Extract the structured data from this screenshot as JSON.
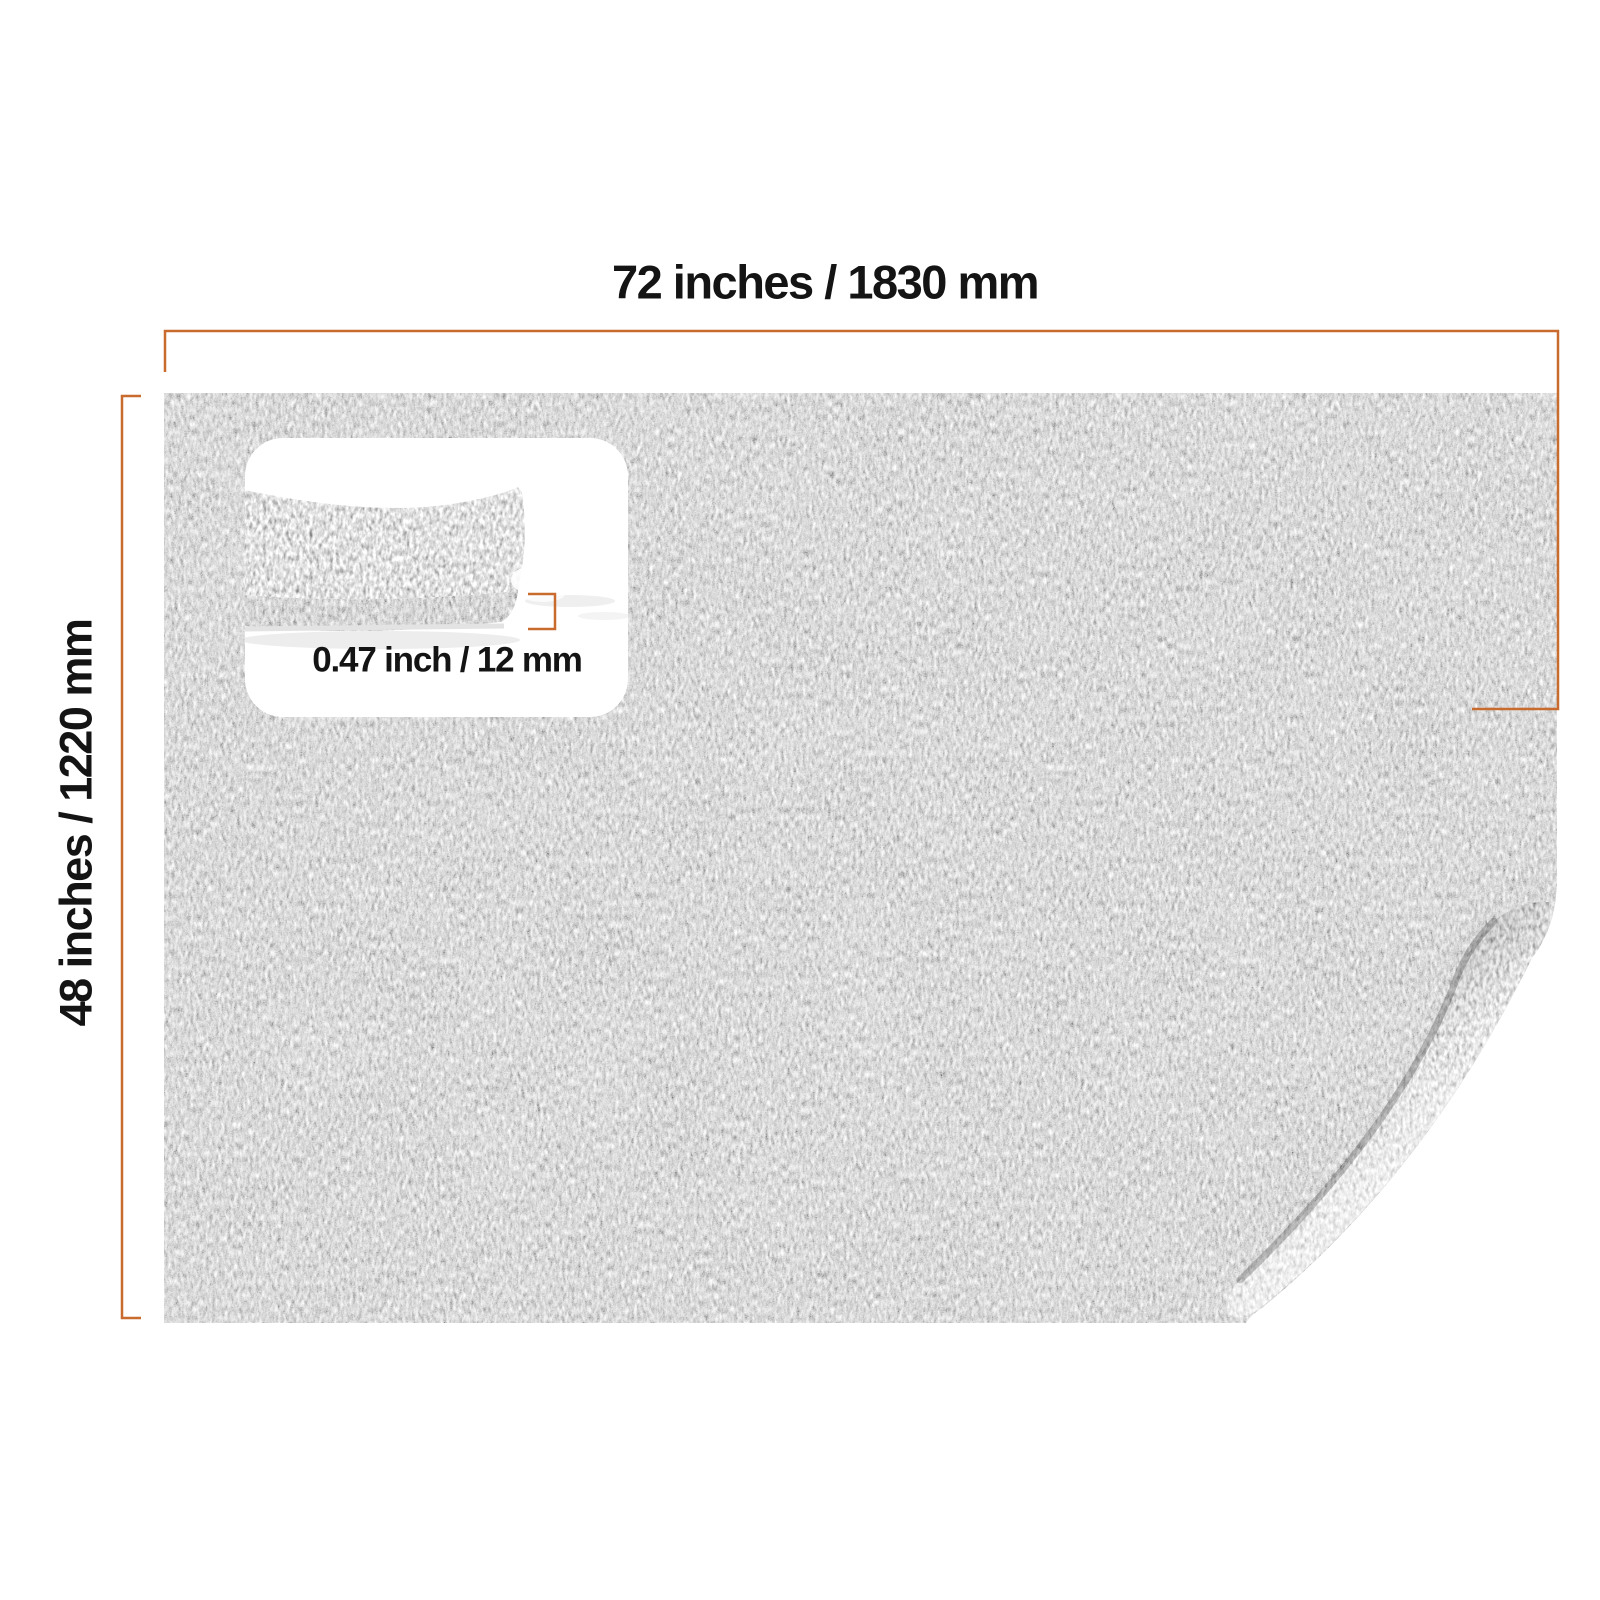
{
  "page": {
    "background": "#ffffff",
    "description": "Product dimension image of a gray felt mat"
  },
  "labels": {
    "width": "72 inches / 1830 mm",
    "height": "48 inches / 1220 mm",
    "thickness": "0.47 inch / 12 mm"
  },
  "colors": {
    "dimension_line": "#c96a2e",
    "label_text": "#141414",
    "felt_base": "#6e6e6e",
    "felt_fold": "#9b9b9b",
    "inset_felt_top": "#8f8f8f",
    "inset_felt_edge": "#36363a",
    "inset_box": "#ffffff"
  },
  "photo": {
    "main": "gray felt mat, top view, bottom-right corner folded over",
    "inset": "close-up side view of felt edge showing thickness"
  }
}
